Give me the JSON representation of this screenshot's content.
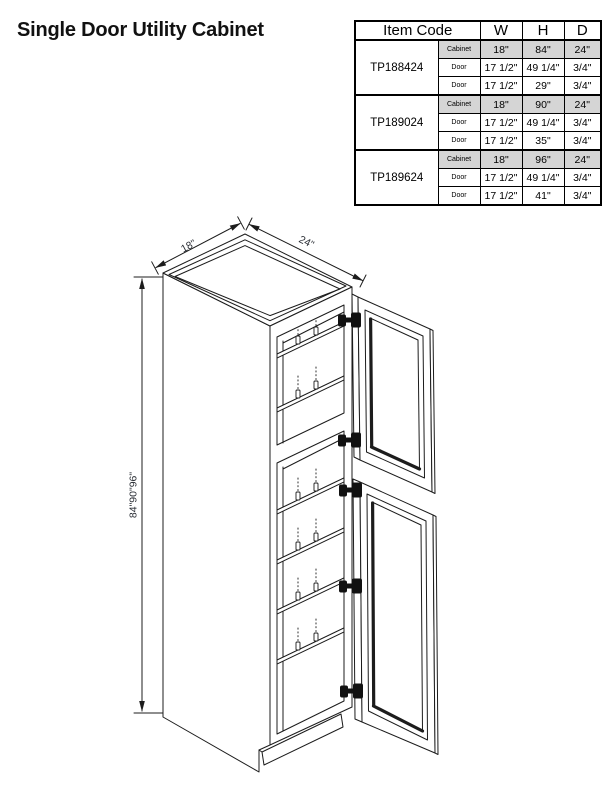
{
  "page": {
    "title": "Single Door Utility Cabinet"
  },
  "spec_table": {
    "headers": {
      "item_code": "Item Code",
      "w": "W",
      "h": "H",
      "d": "D"
    },
    "groups": [
      {
        "code": "TP188424",
        "rows": [
          {
            "label": "Cabinet",
            "w": "18\"",
            "h": "84\"",
            "d": "24\""
          },
          {
            "label": "Door",
            "w": "17 1/2\"",
            "h": "49 1/4\"",
            "d": "3/4\""
          },
          {
            "label": "Door",
            "w": "17 1/2\"",
            "h": "29\"",
            "d": "3/4\""
          }
        ]
      },
      {
        "code": "TP189024",
        "rows": [
          {
            "label": "Cabinet",
            "w": "18\"",
            "h": "90\"",
            "d": "24\""
          },
          {
            "label": "Door",
            "w": "17 1/2\"",
            "h": "49 1/4\"",
            "d": "3/4\""
          },
          {
            "label": "Door",
            "w": "17 1/2\"",
            "h": "35\"",
            "d": "3/4\""
          }
        ]
      },
      {
        "code": "TP189624",
        "rows": [
          {
            "label": "Cabinet",
            "w": "18\"",
            "h": "96\"",
            "d": "24\""
          },
          {
            "label": "Door",
            "w": "17 1/2\"",
            "h": "49 1/4\"",
            "d": "3/4\""
          },
          {
            "label": "Door",
            "w": "17 1/2\"",
            "h": "41\"",
            "d": "3/4\""
          }
        ]
      }
    ]
  },
  "diagram": {
    "dim_depth": "18\"",
    "dim_width": "24\"",
    "dim_height": "84\"90\"96\"",
    "line_color": "#1c1c1c"
  }
}
